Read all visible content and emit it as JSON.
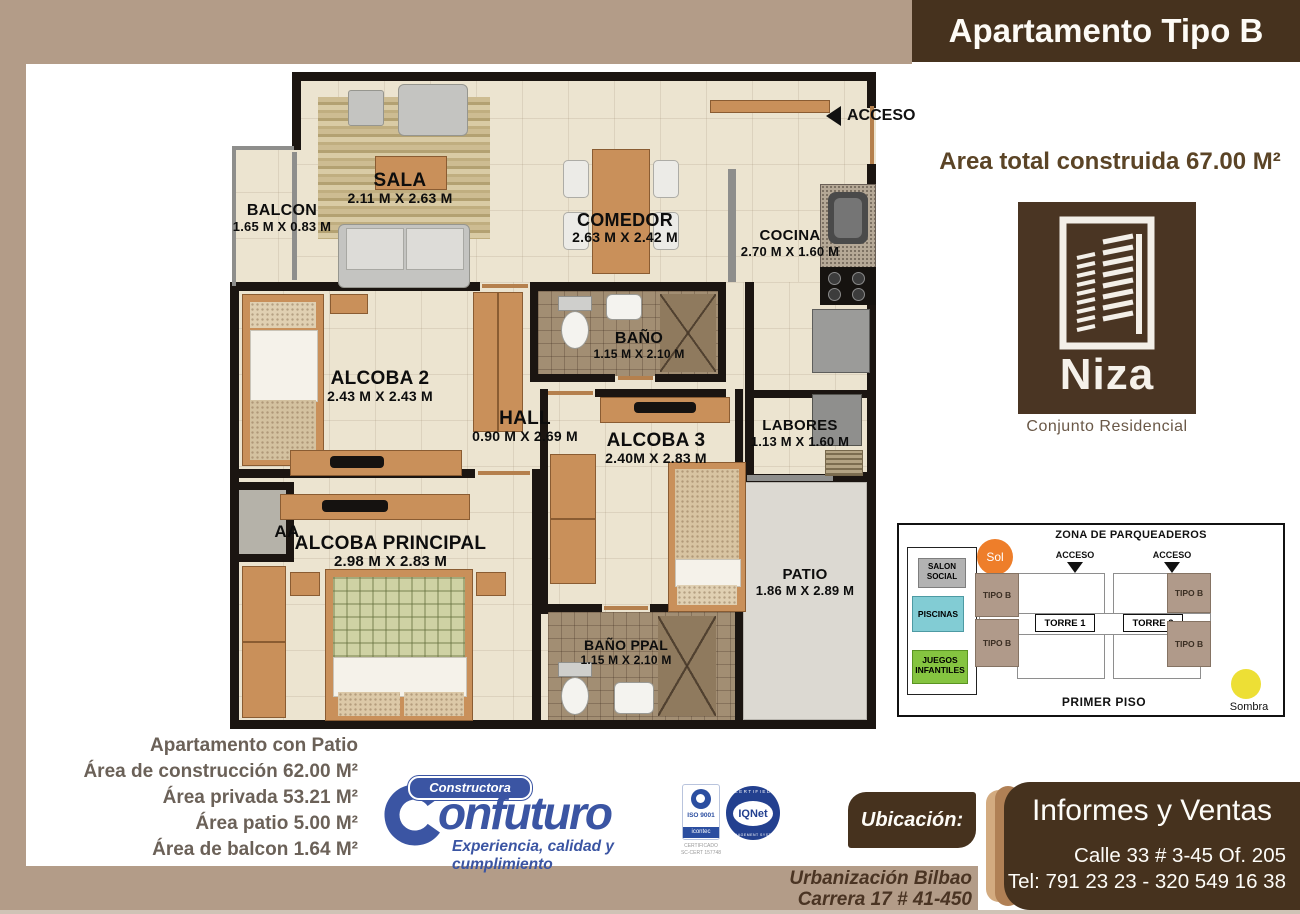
{
  "header": {
    "title": "Apartamento Tipo B"
  },
  "summary": {
    "area_total": "Area total construida 67.00 M²"
  },
  "niza": {
    "name": "Niza",
    "subtitle": "Conjunto Residencial"
  },
  "floor_plan": {
    "acceso": "ACCESO",
    "rooms": [
      {
        "id": "balcon",
        "name": "BALCON",
        "dims": "1.65 M X 0.83 M"
      },
      {
        "id": "sala",
        "name": "SALA",
        "dims": "2.11 M X 2.63 M"
      },
      {
        "id": "comedor",
        "name": "COMEDOR",
        "dims": "2.63 M X 2.42 M"
      },
      {
        "id": "cocina",
        "name": "COCINA",
        "dims": "2.70 M X 1.60 M"
      },
      {
        "id": "bano",
        "name": "BAÑO",
        "dims": "1.15 M X 2.10 M"
      },
      {
        "id": "alcoba2",
        "name": "ALCOBA 2",
        "dims": "2.43 M X 2.43 M"
      },
      {
        "id": "hall",
        "name": "HALL",
        "dims": "0.90 M X 2.69 M"
      },
      {
        "id": "alcoba3",
        "name": "ALCOBA 3",
        "dims": "2.40M X 2.83 M"
      },
      {
        "id": "labores",
        "name": "LABORES",
        "dims": "1.13 M X 1.60 M"
      },
      {
        "id": "alcoba_principal",
        "name": "ALCOBA PRINCIPAL",
        "dims": "2.98 M X 2.83 M"
      },
      {
        "id": "patio",
        "name": "PATIO",
        "dims": "1.86 M X 2.89 M"
      },
      {
        "id": "bano_ppal",
        "name": "BAÑO PPAL",
        "dims": "1.15 M X 2.10 M"
      },
      {
        "id": "aa",
        "name": "AA",
        "dims": ""
      }
    ]
  },
  "site_plan": {
    "title": "ZONA DE PARQUEADEROS",
    "sol": "Sol",
    "sombra": "Sombra",
    "salon_social": "SALON SOCIAL",
    "piscinas": "PISCINAS",
    "juegos": "JUEGOS INFANTILES",
    "acceso": "ACCESO",
    "torre1": "TORRE 1",
    "torre2": "TORRE 2",
    "tipo_b": "TIPO B",
    "primer_piso": "PRIMER PISO"
  },
  "areas": {
    "lines": [
      "Apartamento con Patio",
      "Área de construcción 62.00 M²",
      "Área privada 53.21 M²",
      "Área patio 5.00 M²",
      "Área de balcon 1.64 M²"
    ]
  },
  "builder": {
    "constructora": "Constructora",
    "brand_c": "C",
    "brand_rest": "onfuturo",
    "tagline": "Experiencia, calidad y cumplimiento",
    "iso9001": "ISO 9001",
    "icontec": "icontec",
    "cert_line1": "CERTIFICADO",
    "cert_line2": "SC-CERT 157748",
    "iqnet": "IQNet",
    "iqnet_top": "CERTIFIED",
    "iqnet_bottom": "MANAGEMENT SYSTEM"
  },
  "contact": {
    "ubicacion": "Ubicación:",
    "addr1": "Urbanización Bilbao",
    "addr2": "Carrera 17 # 41-450",
    "informes": "Informes y Ventas",
    "calle": "Calle 33 # 3-45 Of. 205",
    "tel": "Tel: 791 23 23 - 320 549 16 38"
  },
  "colors": {
    "frame": "#b39c88",
    "brown": "#46321e",
    "blue": "#3b55a3",
    "sun": "#ee7e2a",
    "shade": "#eddf35"
  }
}
